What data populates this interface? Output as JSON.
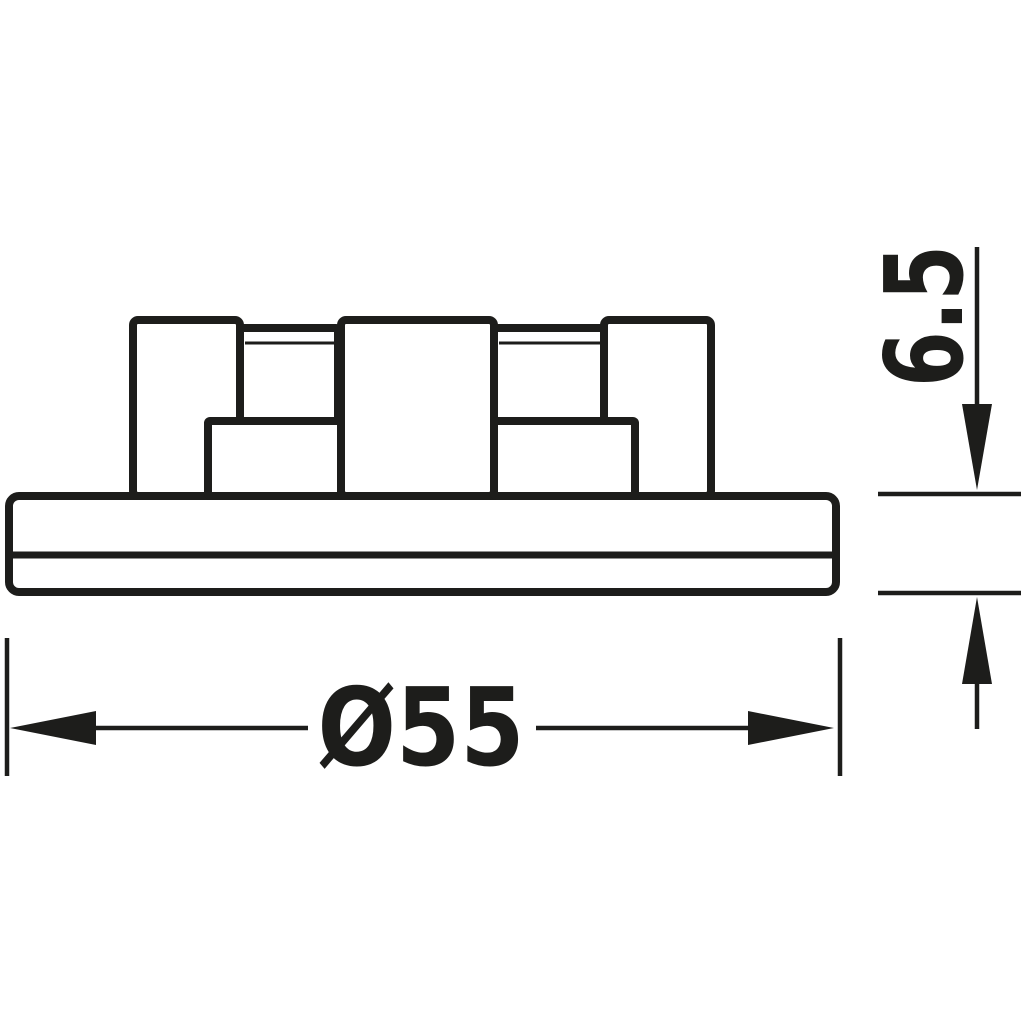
{
  "drawing": {
    "dimensions": {
      "diameter_label": "Ø55",
      "height_label": "6.5"
    },
    "colors": {
      "line": "#1d1d1b",
      "background": "#ffffff"
    }
  }
}
